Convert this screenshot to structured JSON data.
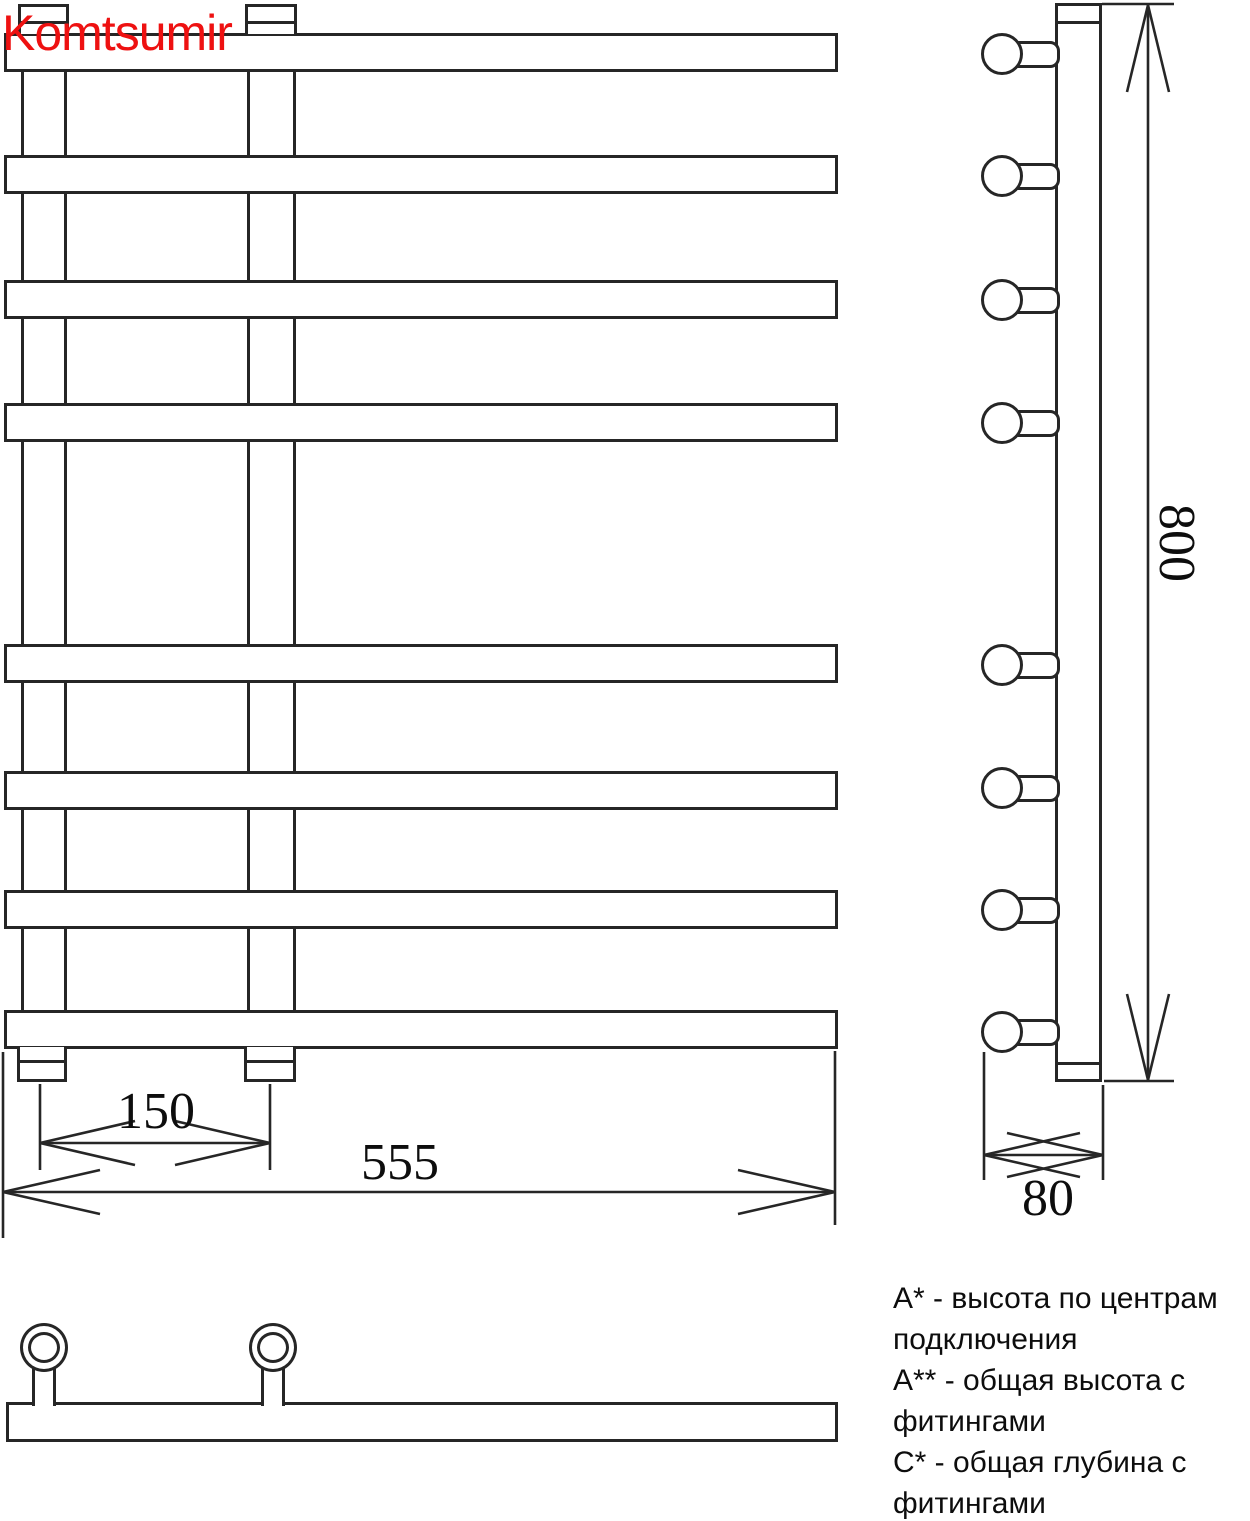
{
  "brand": "Komtsumir",
  "dimensions": {
    "connection_spacing": "150",
    "overall_width": "555",
    "overall_height": "800",
    "overall_depth": "80"
  },
  "legend": {
    "lines": [
      "А* - высота по центрам",
      "подключения",
      "А** - общая высота с",
      "фитингами",
      "С* - общая глубина с",
      "фитингами"
    ]
  },
  "colors": {
    "brand_red": "#ee1111",
    "line_black": "#262626"
  }
}
